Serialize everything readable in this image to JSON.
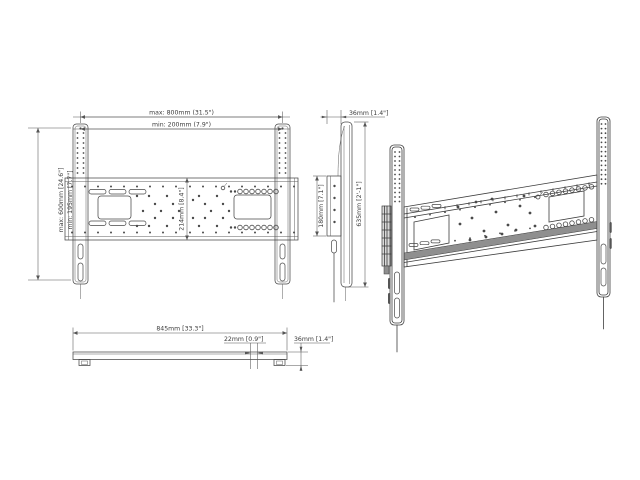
{
  "drawing": {
    "title": "tv-wall-mount-technical-drawing",
    "front": {
      "width_max": "max: 800mm  (31.5\")",
      "width_min": "min: 200mm  (7.9\")",
      "height_max": "max: 600mm  [24.6\"]",
      "height_min": "min: 195mm  [7.7\"]",
      "plate_height": "214mm  [8.4\"]"
    },
    "side": {
      "depth": "36mm  [1.4\"]",
      "plate_height": "180mm  [7.1\"]",
      "rail_height": "635mm  [2'-1\"]"
    },
    "bottom": {
      "overall_width": "845mm  [33.3\"]",
      "end_offset": "22mm  [0.9\"]",
      "depth": "36mm  [1.4\"]"
    }
  }
}
